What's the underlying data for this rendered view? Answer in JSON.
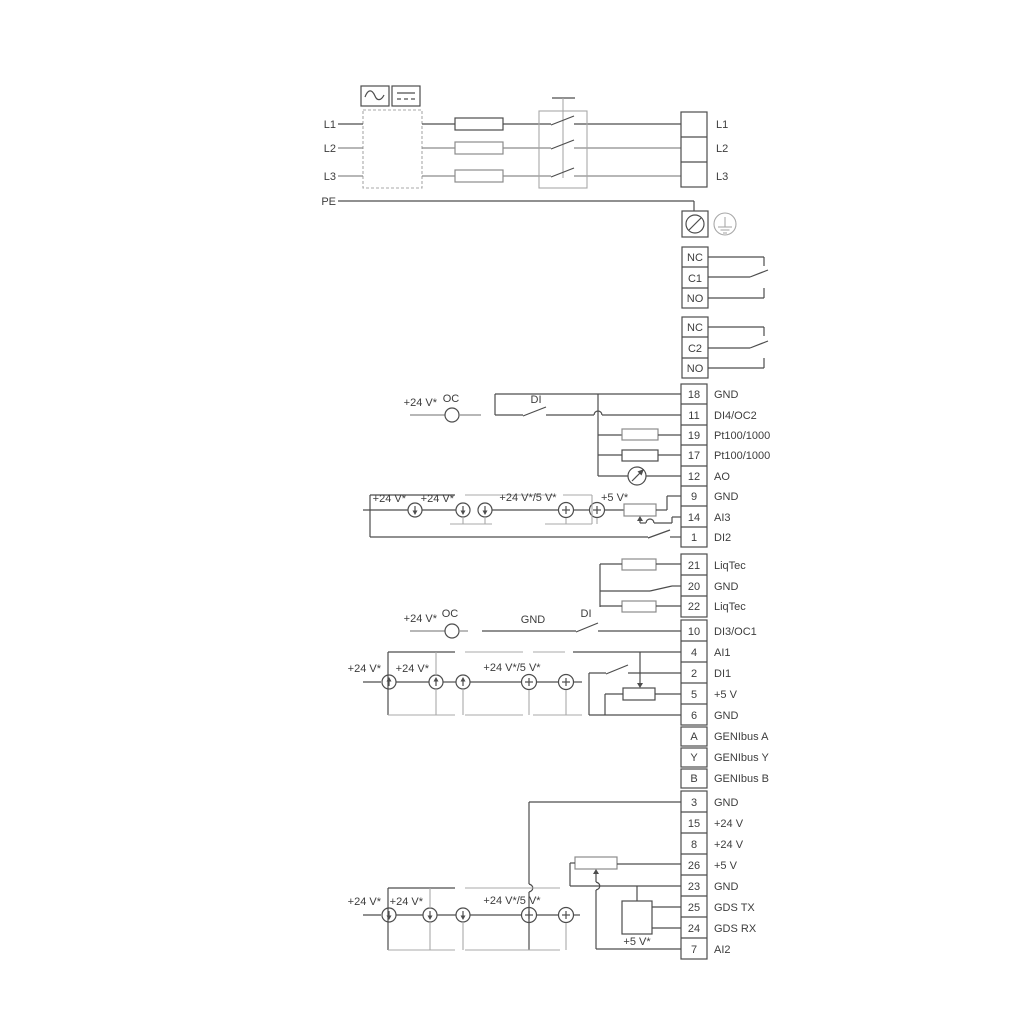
{
  "colors": {
    "line": "#4d4d4d",
    "rail": "#a8a8a8",
    "text": "#3d3d3d",
    "bg": "#ffffff"
  },
  "power": {
    "phase_labels": [
      "L1",
      "L2",
      "L3"
    ],
    "pe_label": "PE",
    "out_labels": [
      "L1",
      "L2",
      "L3"
    ]
  },
  "relay1": {
    "rows": [
      "NC",
      "C1",
      "NO"
    ]
  },
  "relay2": {
    "rows": [
      "NC",
      "C2",
      "NO"
    ]
  },
  "strip1": {
    "rows": [
      {
        "num": "18",
        "label": "GND"
      },
      {
        "num": "11",
        "label": "DI4/OC2"
      },
      {
        "num": "19",
        "label": "Pt100/1000"
      },
      {
        "num": "17",
        "label": "Pt100/1000"
      },
      {
        "num": "12",
        "label": "AO"
      },
      {
        "num": "9",
        "label": "GND"
      },
      {
        "num": "14",
        "label": "AI3"
      },
      {
        "num": "1",
        "label": "DI2"
      }
    ]
  },
  "liqtec": {
    "rows": [
      {
        "num": "21",
        "label": "LiqTec"
      },
      {
        "num": "20",
        "label": "GND"
      },
      {
        "num": "22",
        "label": "LiqTec"
      }
    ]
  },
  "strip2": {
    "rows": [
      {
        "num": "10",
        "label": "DI3/OC1"
      },
      {
        "num": "4",
        "label": "AI1"
      },
      {
        "num": "2",
        "label": "DI1"
      },
      {
        "num": "5",
        "label": "+5 V"
      },
      {
        "num": "6",
        "label": "GND"
      },
      {
        "num": "A",
        "label": "GENIbus A"
      },
      {
        "num": "Y",
        "label": "GENIbus Y"
      },
      {
        "num": "B",
        "label": "GENIbus B"
      }
    ]
  },
  "strip3": {
    "rows": [
      {
        "num": "3",
        "label": "GND"
      },
      {
        "num": "15",
        "label": "+24 V"
      },
      {
        "num": "8",
        "label": "+24 V"
      },
      {
        "num": "26",
        "label": "+5 V"
      },
      {
        "num": "23",
        "label": "GND"
      },
      {
        "num": "25",
        "label": "GDS TX"
      },
      {
        "num": "24",
        "label": "GDS RX"
      },
      {
        "num": "7",
        "label": "AI2"
      }
    ]
  },
  "ann": {
    "di4": {
      "v24": "+24 V*",
      "oc": "OC",
      "di": "DI"
    },
    "ai3": {
      "v24a": "+24 V*",
      "v24b": "+24 V*",
      "v245": "+24 V*/5 V*",
      "v5": "+5 V*"
    },
    "di3": {
      "v24": "+24 V*",
      "oc": "OC",
      "gnd": "GND",
      "di": "DI"
    },
    "ai1": {
      "v24a": "+24 V*",
      "v24b": "+24 V*",
      "v245": "+24 V*/5 V*"
    },
    "ai2": {
      "v24a": "+24 V*",
      "v24b": "+24 V*",
      "v245": "+24 V*/5 V*",
      "v5": "+5 V*"
    }
  }
}
